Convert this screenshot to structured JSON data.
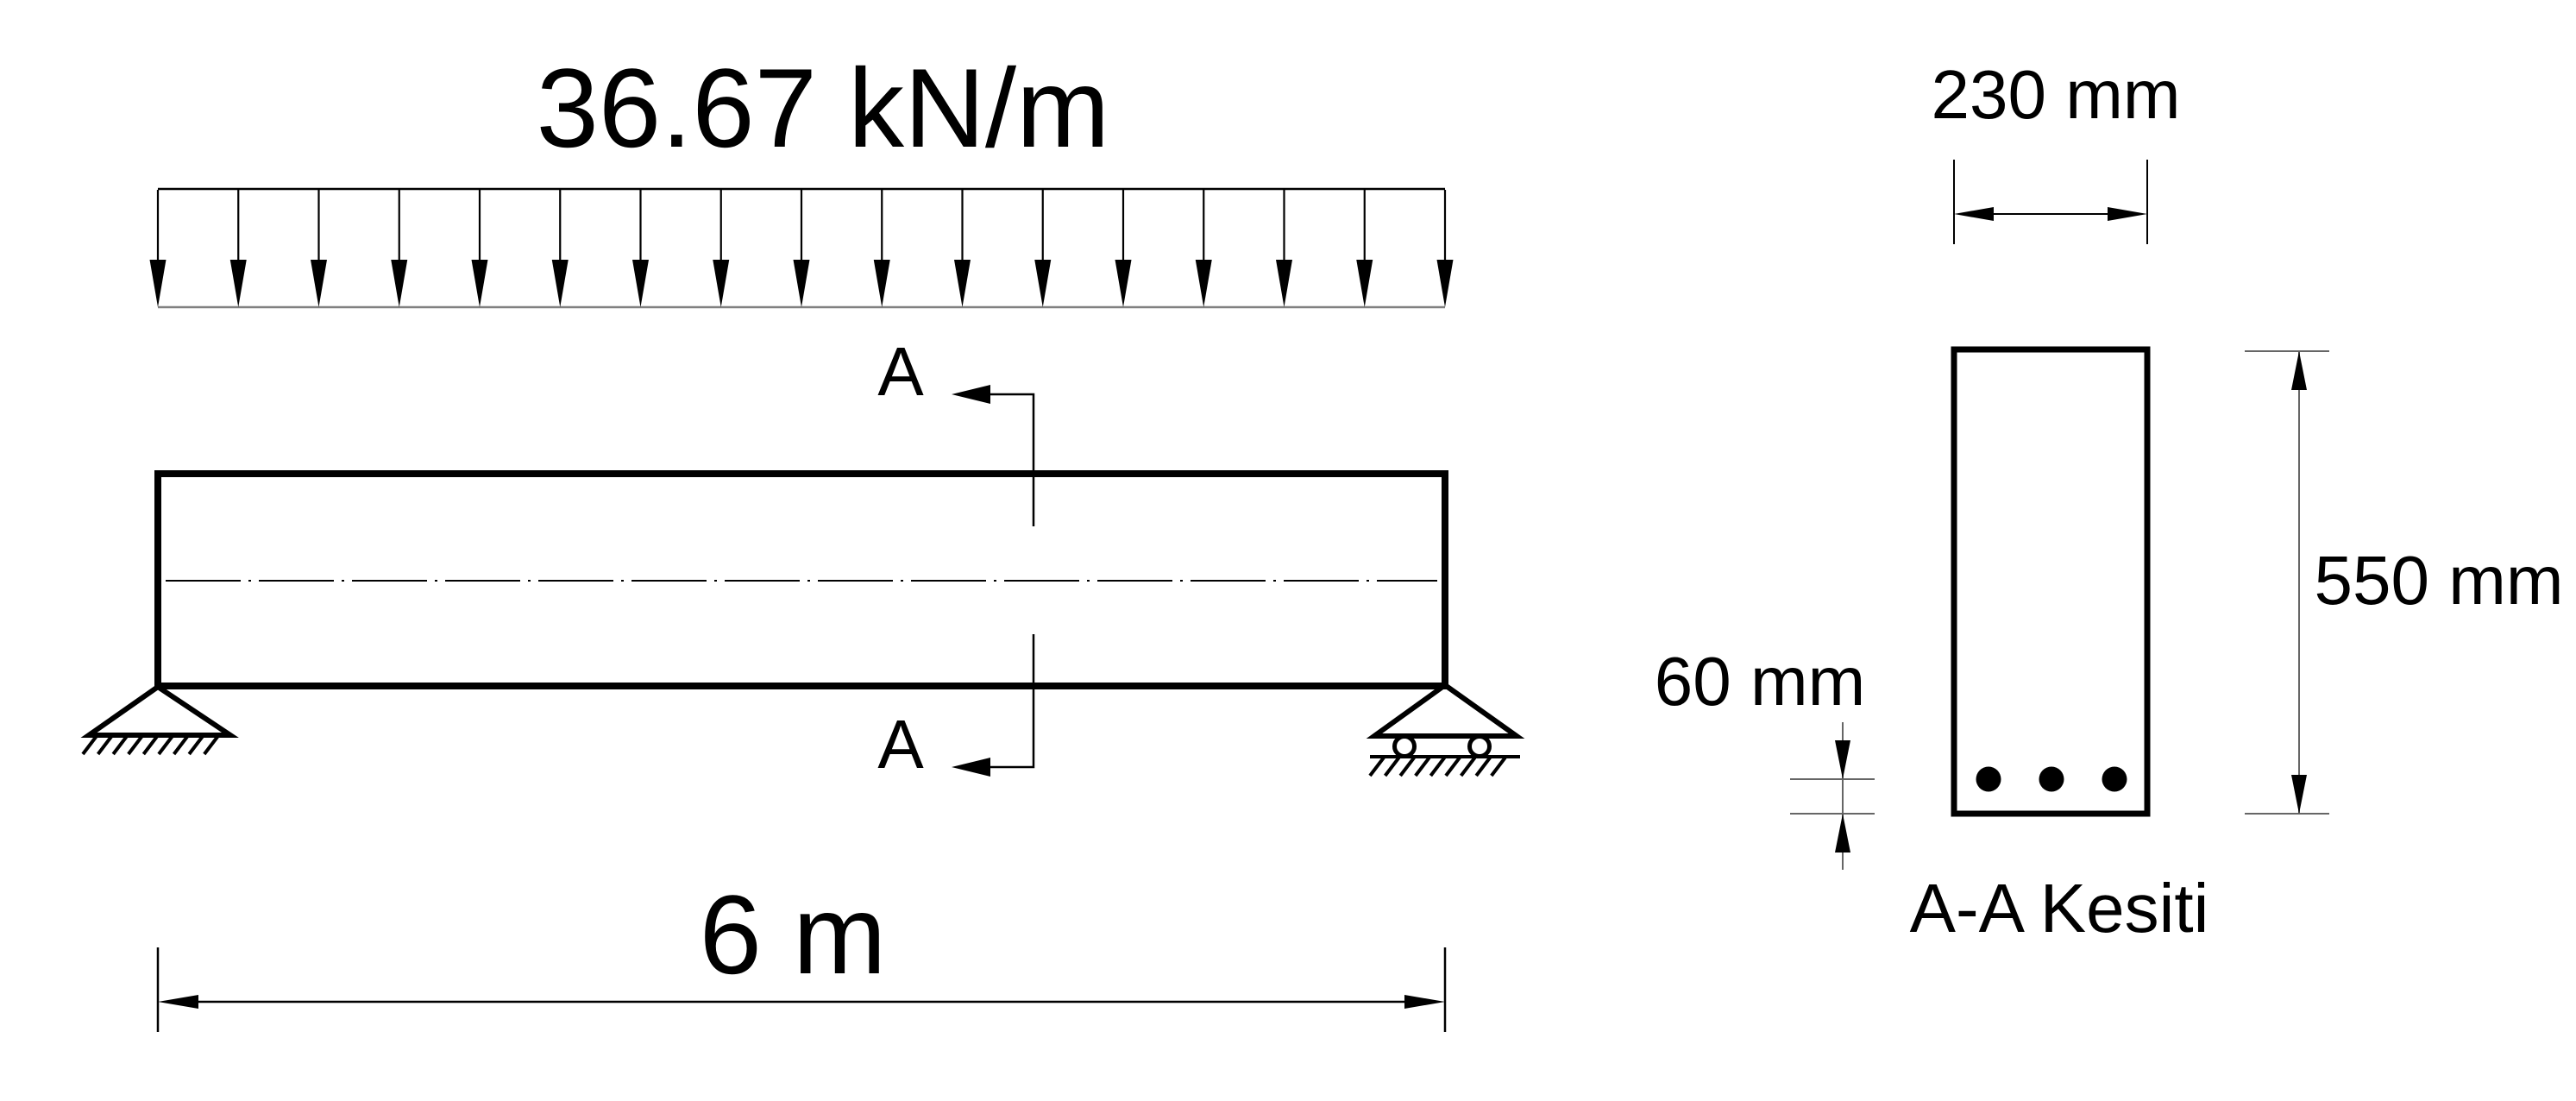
{
  "figure": {
    "background_color": "#ffffff",
    "line_color": "#000000",
    "thin_line_gray": "#808080"
  },
  "beam_diagram": {
    "load_label": "36.67 kN/m",
    "load_arrow_count": 17,
    "span_label": "6 m",
    "section_label_top": "A",
    "section_label_bottom": "A",
    "left_support": "pin",
    "right_support": "roller"
  },
  "section_view": {
    "width_label": "230 mm",
    "height_label": "550 mm",
    "cover_label": "60 mm",
    "caption": "A-A Kesiti",
    "rebar_count": 3
  }
}
